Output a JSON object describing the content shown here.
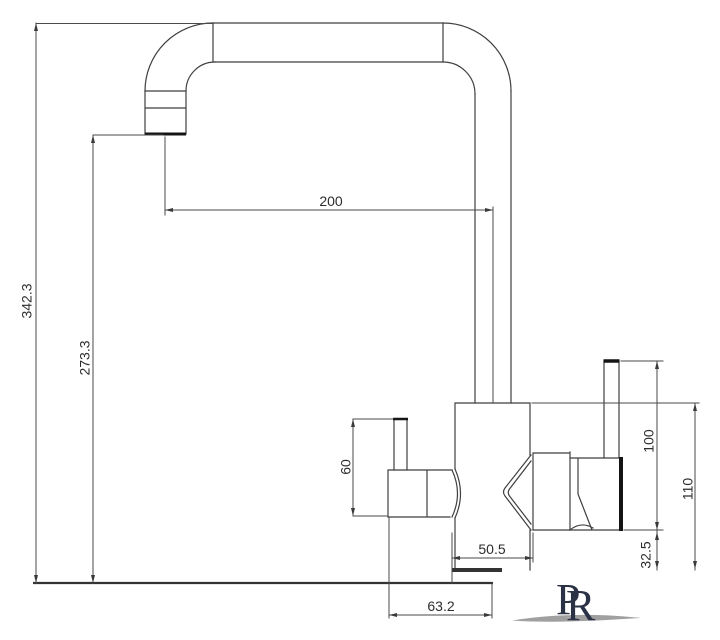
{
  "dimensions": {
    "overall_height": "342.3",
    "spout_outlet_height": "273.3",
    "spout_reach": "200",
    "side_handle_height": "60",
    "handle_height": "100",
    "body_height": "110",
    "handle_clearance": "32.5",
    "base_width": "50.5",
    "side_valve_offset": "63.2"
  },
  "logo": {
    "monogram_left": "P",
    "monogram_right": "R"
  },
  "colors": {
    "line": "#3f3f3f",
    "dark_edge": "#141414",
    "logo_navy": "#2b3246",
    "swoosh_gray": "#8f8f8f"
  }
}
